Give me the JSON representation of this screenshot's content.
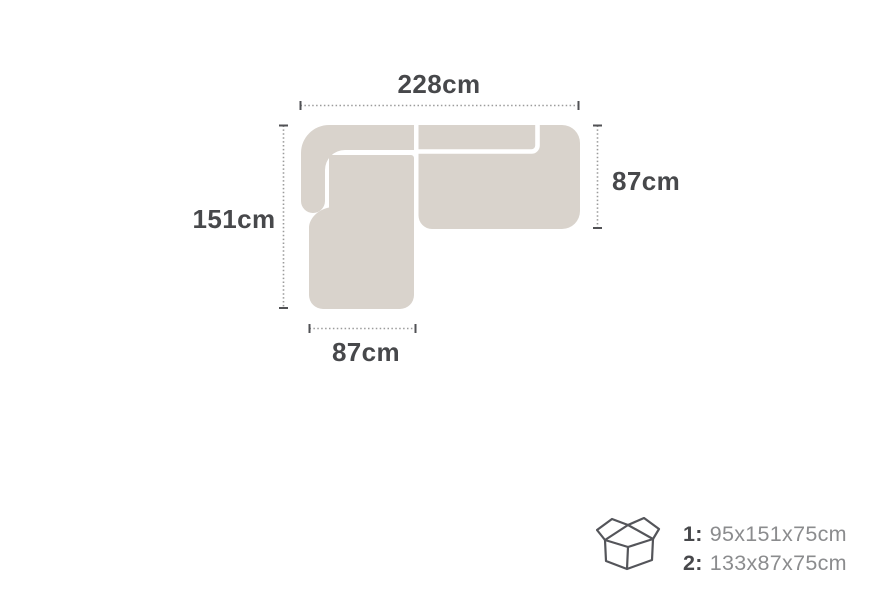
{
  "dimensions": {
    "top": "228cm",
    "right": "87cm",
    "left": "151cm",
    "bottom": "87cm"
  },
  "boxes": [
    {
      "label": "1:",
      "dims": "95x151x75cm"
    },
    {
      "label": "2:",
      "dims": "133x87x75cm"
    }
  ],
  "icons": {
    "box_icon": "open-cardboard-box"
  },
  "colors": {
    "sofa_fill": "#d9d3cc",
    "seam": "#ffffff",
    "dim_line": "#9b9b9b",
    "tick": "#515255",
    "label_text": "#47484b",
    "box_number_text": "#47484b",
    "box_dims_text": "#8b8c8e",
    "icon_stroke": "#54555a"
  }
}
